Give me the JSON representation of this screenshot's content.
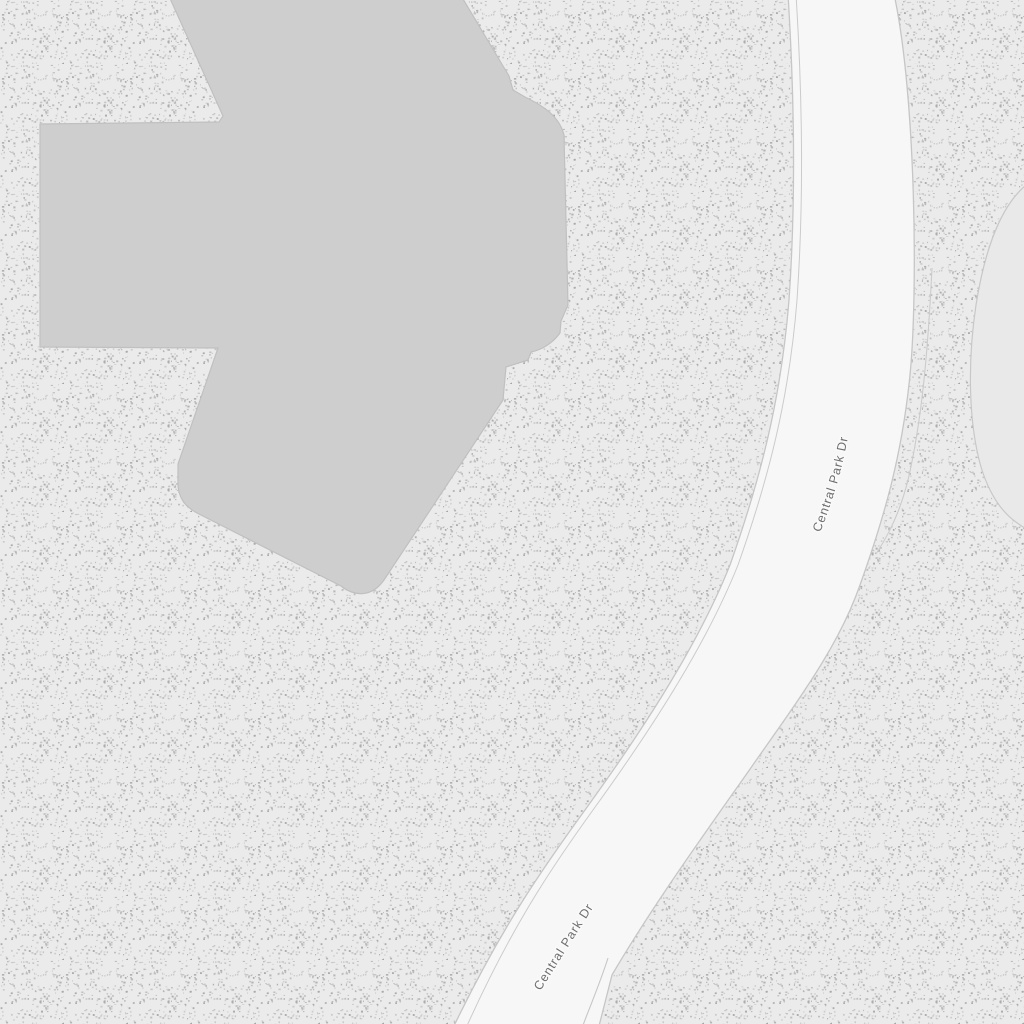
{
  "road": {
    "name": "Central Park Dr"
  },
  "labels": {
    "road_label_upper": "Central Park Dr",
    "road_label_lower": "Central Park Dr"
  },
  "colors": {
    "park_background": "#ebebeb",
    "stipple_dot": "#9e9e9e",
    "building_fill": "#cecece",
    "building_stroke": "#c0c0c0",
    "road_fill": "#f7f7f7",
    "road_casing": "#c6c6c6",
    "clearing_fill": "#e9e9e9",
    "clearing_stroke": "#c8c8c8",
    "trail_stroke": "#cbcbcb",
    "label_text": "#6e6e6e",
    "label_halo": "#fafafa"
  }
}
